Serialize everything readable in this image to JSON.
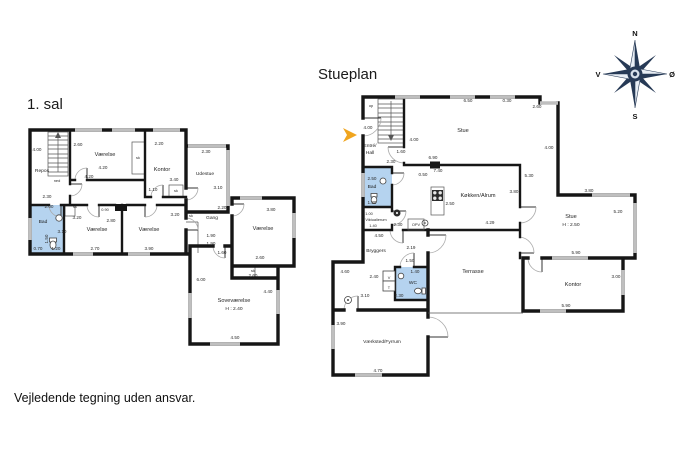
{
  "titles": {
    "first_floor": "1. sal",
    "ground_floor": "Stueplan"
  },
  "disclaimer": "Vejledende tegning uden ansvar.",
  "compass": {
    "north": "N",
    "south": "S",
    "west": "V",
    "east": "Ø"
  },
  "colors": {
    "wall": "#161616",
    "window_marker": "#bfbfbf",
    "wet_room_fill": "#b5d3ef",
    "entrance_arrow": "#f0a51e",
    "compass_dark": "#273a56",
    "door_arc": "#aaaaaa"
  },
  "first_floor": {
    "labels": [
      {
        "t": "Repos",
        "x": 17,
        "y": 54,
        "c": "room-sm"
      },
      {
        "t": "ned",
        "x": 32,
        "y": 64,
        "c": "tiny"
      },
      {
        "t": "4.00",
        "x": 12,
        "y": 33,
        "c": "dim"
      },
      {
        "t": "2.30",
        "x": 22,
        "y": 80,
        "c": "dim"
      },
      {
        "t": "Værelse",
        "x": 80,
        "y": 38,
        "c": "room"
      },
      {
        "t": "2.60",
        "x": 53,
        "y": 28,
        "c": "dim"
      },
      {
        "t": "4.20",
        "x": 78,
        "y": 51,
        "c": "dim"
      },
      {
        "t": "4.20",
        "x": 64,
        "y": 60,
        "c": "dim"
      },
      {
        "t": "sk",
        "x": 113,
        "y": 41,
        "c": "tiny"
      },
      {
        "t": "Kontor",
        "x": 137,
        "y": 53,
        "c": "room"
      },
      {
        "t": "2.20",
        "x": 134,
        "y": 27,
        "c": "dim"
      },
      {
        "t": "3.40",
        "x": 149,
        "y": 63,
        "c": "dim"
      },
      {
        "t": "sk",
        "x": 151,
        "y": 74,
        "c": "tiny"
      },
      {
        "t": "Udestue",
        "x": 180,
        "y": 57,
        "c": "room-sm"
      },
      {
        "t": "2.30",
        "x": 181,
        "y": 35,
        "c": "dim"
      },
      {
        "t": "3.10",
        "x": 193,
        "y": 71,
        "c": "dim"
      },
      {
        "t": "1.10",
        "x": 128,
        "y": 73,
        "c": "dim"
      },
      {
        "t": "0.90",
        "x": 80,
        "y": 93,
        "c": "tiny"
      },
      {
        "t": "sk",
        "x": 50,
        "y": 90,
        "c": "tiny"
      },
      {
        "t": "2.00",
        "x": 24,
        "y": 90,
        "c": "dim"
      },
      {
        "t": "Bad",
        "x": 18,
        "y": 105,
        "c": "room-sm"
      },
      {
        "t": "3.10",
        "x": 37,
        "y": 115,
        "c": "dim"
      },
      {
        "t": "1.50",
        "x": 23,
        "y": 121,
        "c": "dim",
        "r": -90
      },
      {
        "t": "0.70",
        "x": 13,
        "y": 132,
        "c": "dim"
      },
      {
        "t": "1.20",
        "x": 31,
        "y": 132,
        "c": "dim"
      },
      {
        "t": "Værelse",
        "x": 72,
        "y": 113,
        "c": "room"
      },
      {
        "t": "3.20",
        "x": 52,
        "y": 101,
        "c": "dim"
      },
      {
        "t": "2.80",
        "x": 86,
        "y": 104,
        "c": "dim"
      },
      {
        "t": "2.70",
        "x": 70,
        "y": 132,
        "c": "dim"
      },
      {
        "t": "Værelse",
        "x": 124,
        "y": 113,
        "c": "room"
      },
      {
        "t": "3.90",
        "x": 124,
        "y": 132,
        "c": "dim"
      },
      {
        "t": "3.20",
        "x": 150,
        "y": 98,
        "c": "dim"
      },
      {
        "t": "sk",
        "x": 166,
        "y": 99,
        "c": "tiny"
      },
      {
        "t": "Gang",
        "x": 187,
        "y": 101,
        "c": "room-sm"
      },
      {
        "t": "2.20",
        "x": 197,
        "y": 91,
        "c": "dim"
      },
      {
        "t": "1.90",
        "x": 186,
        "y": 119,
        "c": "dim"
      },
      {
        "t": "1.90",
        "x": 186,
        "y": 127,
        "c": "dim"
      },
      {
        "t": "1.60",
        "x": 197,
        "y": 136,
        "c": "dim"
      },
      {
        "t": "Værelse",
        "x": 238,
        "y": 112,
        "c": "room"
      },
      {
        "t": "3.80",
        "x": 246,
        "y": 93,
        "c": "dim"
      },
      {
        "t": "2.60",
        "x": 235,
        "y": 141,
        "c": "dim"
      },
      {
        "t": "sk",
        "x": 228,
        "y": 154,
        "c": "tiny"
      },
      {
        "t": "2.60",
        "x": 228,
        "y": 159,
        "c": "dim"
      },
      {
        "t": "Soveværelse",
        "x": 209,
        "y": 184,
        "c": "room"
      },
      {
        "t": "H : 2.40",
        "x": 209,
        "y": 192,
        "c": "room-sm"
      },
      {
        "t": "6.00",
        "x": 176,
        "y": 163,
        "c": "dim"
      },
      {
        "t": "4.40",
        "x": 243,
        "y": 175,
        "c": "dim"
      },
      {
        "t": "4.50",
        "x": 210,
        "y": 221,
        "c": "dim"
      }
    ]
  },
  "ground_floor": {
    "labels": [
      {
        "t": "op",
        "x": 41,
        "y": 22,
        "c": "tiny"
      },
      {
        "t": "4.00",
        "x": 38,
        "y": 44,
        "c": "dim"
      },
      {
        "t": "Entré/",
        "x": 40,
        "y": 62,
        "c": "room-sm"
      },
      {
        "t": "Hall",
        "x": 40,
        "y": 69,
        "c": "room-sm"
      },
      {
        "t": "4.00",
        "x": 84,
        "y": 56,
        "c": "dim"
      },
      {
        "t": "1.60",
        "x": 71,
        "y": 68,
        "c": "dim"
      },
      {
        "t": "2.30",
        "x": 61,
        "y": 78,
        "c": "dim"
      },
      {
        "t": "Stue",
        "x": 133,
        "y": 47,
        "c": "room"
      },
      {
        "t": "6.50",
        "x": 138,
        "y": 17,
        "c": "dim"
      },
      {
        "t": "0.30",
        "x": 177,
        "y": 17,
        "c": "dim"
      },
      {
        "t": "2.60",
        "x": 207,
        "y": 23,
        "c": "dim"
      },
      {
        "t": "4.00",
        "x": 219,
        "y": 64,
        "c": "dim"
      },
      {
        "t": "6.90",
        "x": 103,
        "y": 74,
        "c": "dim"
      },
      {
        "t": "7.40",
        "x": 108,
        "y": 87,
        "c": "dim"
      },
      {
        "t": "0.50",
        "x": 93,
        "y": 91,
        "c": "dim"
      },
      {
        "t": "2.50",
        "x": 42,
        "y": 95,
        "c": "dim"
      },
      {
        "t": "Bad",
        "x": 42,
        "y": 103,
        "c": "room-sm"
      },
      {
        "t": "1.30",
        "x": 42,
        "y": 119,
        "c": "dim"
      },
      {
        "t": "1.00",
        "x": 39,
        "y": 130,
        "c": "tiny"
      },
      {
        "t": "Viktualierum",
        "x": 46,
        "y": 136,
        "c": "tiny"
      },
      {
        "t": "1.40",
        "x": 43,
        "y": 142,
        "c": "tiny"
      },
      {
        "t": "Køkken/Alrum",
        "x": 148,
        "y": 112,
        "c": "room"
      },
      {
        "t": "2.50",
        "x": 120,
        "y": 120,
        "c": "dim"
      },
      {
        "t": "5.30",
        "x": 199,
        "y": 92,
        "c": "dim"
      },
      {
        "t": "3.80",
        "x": 184,
        "y": 108,
        "c": "dim"
      },
      {
        "t": "3.80",
        "x": 259,
        "y": 107,
        "c": "dim"
      },
      {
        "t": "5.20",
        "x": 288,
        "y": 128,
        "c": "dim"
      },
      {
        "t": "Stue",
        "x": 241,
        "y": 133,
        "c": "room"
      },
      {
        "t": "H : 2.50",
        "x": 241,
        "y": 141,
        "c": "room-sm"
      },
      {
        "t": "4.29",
        "x": 160,
        "y": 139,
        "c": "dim"
      },
      {
        "t": "2.30",
        "x": 68,
        "y": 141,
        "c": "dim"
      },
      {
        "t": "OPV",
        "x": 86,
        "y": 141,
        "c": "tiny"
      },
      {
        "t": "4.50",
        "x": 49,
        "y": 152,
        "c": "dim"
      },
      {
        "t": "Bryggers",
        "x": 46,
        "y": 167,
        "c": "room-sm"
      },
      {
        "t": "2.19",
        "x": 81,
        "y": 164,
        "c": "dim"
      },
      {
        "t": "1.50",
        "x": 80,
        "y": 177,
        "c": "dim"
      },
      {
        "t": "1.40",
        "x": 85,
        "y": 188,
        "c": "dim"
      },
      {
        "t": "WC",
        "x": 83,
        "y": 199,
        "c": "room-sm"
      },
      {
        "t": "V",
        "x": 59,
        "y": 194,
        "c": "tiny"
      },
      {
        "t": "T",
        "x": 59,
        "y": 204,
        "c": "tiny"
      },
      {
        "t": "2.40",
        "x": 44,
        "y": 193,
        "c": "dim"
      },
      {
        "t": "3.10",
        "x": 35,
        "y": 212,
        "c": "dim"
      },
      {
        "t": "2.30",
        "x": 69,
        "y": 212,
        "c": "dim"
      },
      {
        "t": "4.60",
        "x": 15,
        "y": 188,
        "c": "dim"
      },
      {
        "t": "Terrasse",
        "x": 143,
        "y": 188,
        "c": "room"
      },
      {
        "t": "5.90",
        "x": 246,
        "y": 169,
        "c": "dim"
      },
      {
        "t": "Kontor",
        "x": 243,
        "y": 201,
        "c": "room"
      },
      {
        "t": "3.00",
        "x": 286,
        "y": 193,
        "c": "dim"
      },
      {
        "t": "5.90",
        "x": 236,
        "y": 222,
        "c": "dim"
      },
      {
        "t": "3.90",
        "x": 11,
        "y": 240,
        "c": "dim"
      },
      {
        "t": "Værksted/Fyrrum",
        "x": 52,
        "y": 258,
        "c": "room-sm"
      },
      {
        "t": "4.70",
        "x": 48,
        "y": 287,
        "c": "dim"
      }
    ]
  }
}
